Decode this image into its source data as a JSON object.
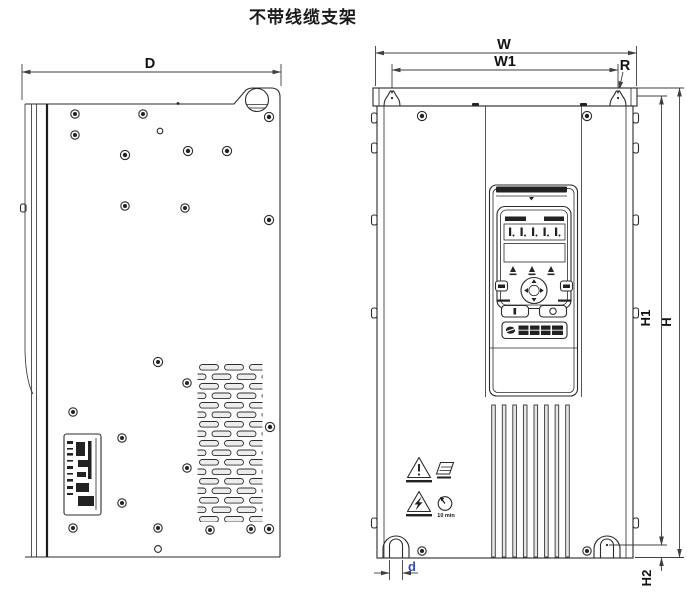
{
  "title": "不带线缆支架",
  "dimensions": {
    "depth": "D",
    "width": "W",
    "mount_width": "W1",
    "mount_hole_radius": "R",
    "height": "H",
    "mount_height": "H1",
    "bottom_offset": "H2",
    "slot_diameter": "d"
  },
  "front_view": {
    "wait_time_label": "10 min"
  },
  "icons": {
    "caution": "warning-triangle-exclamation-icon",
    "electric_hazard": "warning-triangle-lightning-icon",
    "read_manual": "manual-book-icon",
    "discharge_wait": "wait-clock-icon",
    "keypad_navigation": "nav-ring-icon",
    "brand": "brand-logo"
  },
  "colors": {
    "line": "#2b2b2b",
    "dimension_line": "#3f3f3f",
    "slot_diameter_label": "#3649b8",
    "background": "#ffffff"
  }
}
